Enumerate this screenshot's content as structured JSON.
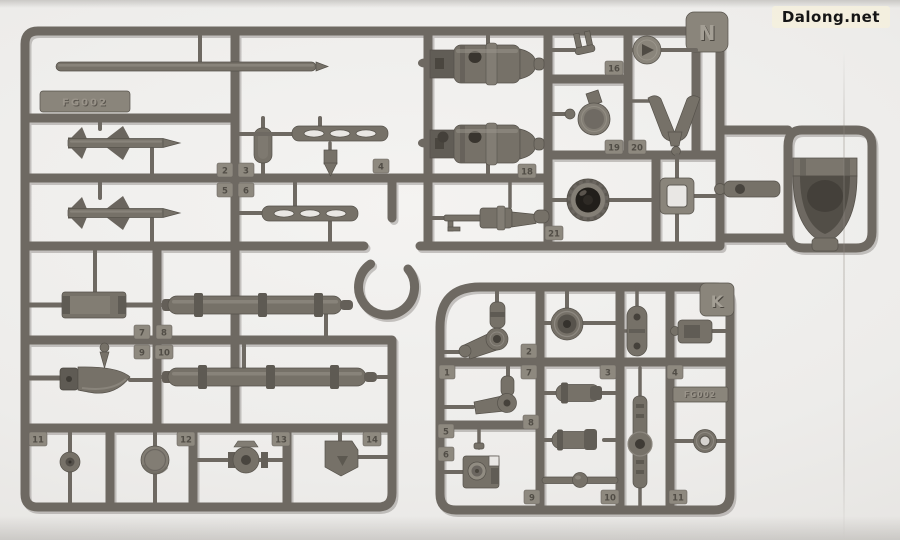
{
  "watermark": {
    "text": "Dalong.net"
  },
  "photo": {
    "subject": "plastic model kit runners (sprues) photographed on light backdrop",
    "background_color": "#edecea",
    "plastic_color": "#6e6962",
    "plastic_highlight": "#8a857b",
    "plastic_shadow": "#55514a",
    "lens_color": "#211e1a"
  },
  "sprue_n": {
    "label": "N",
    "code": "FG002",
    "part_numbers": [
      "2",
      "3",
      "5",
      "6",
      "4",
      "16",
      "19",
      "20",
      "18",
      "21",
      "7",
      "8",
      "9",
      "10",
      "11",
      "12",
      "13",
      "14"
    ],
    "parts": [
      "long-thin-rod",
      "finned-missile x2",
      "flat-paddle",
      "slotted-rail x2",
      "small-bullet",
      "engine-pod x2",
      "scoped-rifle",
      "clevis-fork",
      "pulley-disc",
      "capped-disc",
      "v-shaped-antenna",
      "dark-lens-thruster",
      "square-frame",
      "ball-joint-link",
      "saddle-collar",
      "ammo-magazine",
      "curved-heat-knife",
      "small-spike",
      "ribbed-barrel x2",
      "hub-wheel",
      "round-disc",
      "flanged-cylinder",
      "angled-bracket"
    ]
  },
  "sprue_k": {
    "label": "K",
    "code": "FG002",
    "part_numbers": [
      "1",
      "2",
      "3",
      "4",
      "5",
      "6",
      "7",
      "8",
      "9",
      "10",
      "11"
    ],
    "parts": [
      "elbow-joint x2",
      "ring-washer",
      "camera-bracket",
      "banded-cylinder x2",
      "ball-center-rod",
      "slotted-oval-plate",
      "connector-box",
      "toothed-linkage-arm",
      "small-donut"
    ]
  }
}
